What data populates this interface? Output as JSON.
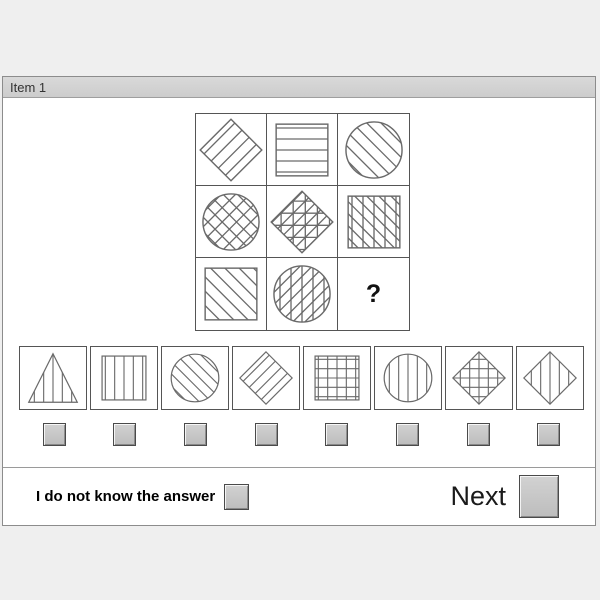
{
  "window": {
    "title": "Item 1"
  },
  "colors": {
    "outline": "#6a6a6a",
    "titlebar_bg": "#d2d2d2",
    "button_face": "#c6c6c6",
    "separator": "#9a9a9a",
    "page_bg": "#efefef"
  },
  "matrix": {
    "question_label": "?",
    "cells": [
      {
        "shape": "diamond",
        "pattern": "diag-up"
      },
      {
        "shape": "square",
        "pattern": "horizontal"
      },
      {
        "shape": "circle",
        "pattern": "diag-down"
      },
      {
        "shape": "circle",
        "pattern": "cross-diag"
      },
      {
        "shape": "diamond",
        "pattern": "grid-diag"
      },
      {
        "shape": "square",
        "pattern": "vertical-diag-down"
      },
      {
        "shape": "square",
        "pattern": "diag-down"
      },
      {
        "shape": "circle",
        "pattern": "vertical-diag-up"
      },
      {
        "shape": "question",
        "pattern": "none"
      }
    ]
  },
  "options": [
    {
      "shape": "triangle",
      "pattern": "vertical"
    },
    {
      "shape": "square",
      "pattern": "vertical"
    },
    {
      "shape": "circle",
      "pattern": "diag-down"
    },
    {
      "shape": "diamond",
      "pattern": "diag-up"
    },
    {
      "shape": "square",
      "pattern": "grid"
    },
    {
      "shape": "circle",
      "pattern": "vertical"
    },
    {
      "shape": "diamond",
      "pattern": "grid"
    },
    {
      "shape": "diamond",
      "pattern": "vertical"
    }
  ],
  "answer_buttons": {
    "count": 8
  },
  "footer": {
    "dont_know_label": "I do not know the answer",
    "next_label": "Next"
  }
}
